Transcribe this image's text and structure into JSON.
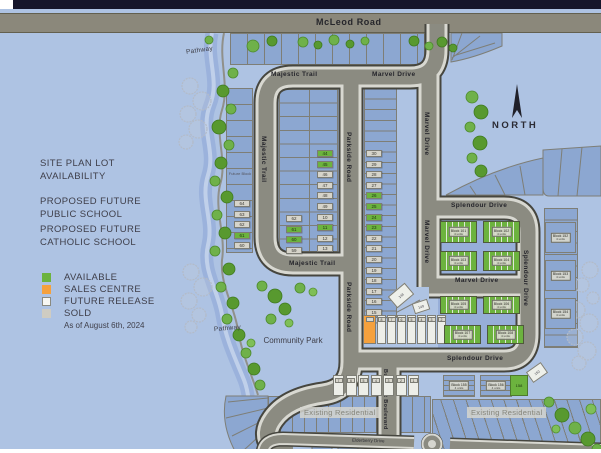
{
  "roads": {
    "mcleod": "McLeod Road",
    "majestic": "Majestic Trail",
    "marvel": "Marvel Drive",
    "parkside": "Parkside Road",
    "splendour": "Splendour Drive",
    "butternut": "Butternut Boulevard",
    "elderberry": "Elderberry Drive"
  },
  "titles": {
    "site_plan": "SITE PLAN LOT AVAILABILITY",
    "public_school": "PROPOSED FUTURE PUBLIC SCHOOL",
    "catholic_school": "PROPOSED FUTURE CATHOLIC SCHOOL"
  },
  "legend": {
    "items": [
      {
        "label": "AVAILABLE",
        "style": "available",
        "color": "#6cb33e"
      },
      {
        "label": "SALES CENTRE",
        "style": "sales",
        "color": "#f5a13d"
      },
      {
        "label": "FUTURE RELEASE",
        "style": "future",
        "color": "#f7f7f2"
      },
      {
        "label": "SOLD",
        "style": "sold",
        "color": "#cfccc2"
      }
    ],
    "as_of": "As of August 6th, 2024"
  },
  "labels": {
    "pathway": "Pathway",
    "community_park": "Community Park",
    "existing_residential": "Existing Residential",
    "north": "NORTH",
    "future_block": "Future Block"
  },
  "lots": {
    "creek_column": [
      {
        "n": "64",
        "status": "sold"
      },
      {
        "n": "63",
        "status": "sold"
      },
      {
        "n": "62",
        "status": "sold"
      },
      {
        "n": "61",
        "status": "available"
      },
      {
        "n": "60",
        "status": "sold"
      }
    ],
    "majestic_left": [
      {
        "n": "62",
        "status": "sold"
      },
      {
        "n": "61",
        "status": "available"
      },
      {
        "n": "60",
        "status": "available"
      },
      {
        "n": "59",
        "status": "sold"
      }
    ],
    "majestic_right": [
      {
        "n": "44",
        "status": "available"
      },
      {
        "n": "45",
        "status": "available"
      },
      {
        "n": "46",
        "status": "sold"
      },
      {
        "n": "47",
        "status": "sold"
      },
      {
        "n": "48",
        "status": "sold"
      },
      {
        "n": "49",
        "status": "sold"
      },
      {
        "n": "10",
        "status": "sold"
      },
      {
        "n": "11",
        "status": "available"
      },
      {
        "n": "12",
        "status": "sold"
      },
      {
        "n": "13",
        "status": "sold"
      }
    ],
    "parkside_column": [
      {
        "n": "30",
        "status": "sold"
      },
      {
        "n": "29",
        "status": "sold"
      },
      {
        "n": "28",
        "status": "sold"
      },
      {
        "n": "27",
        "status": "sold"
      },
      {
        "n": "26",
        "status": "available"
      },
      {
        "n": "25",
        "status": "available"
      },
      {
        "n": "24",
        "status": "available"
      },
      {
        "n": "23",
        "status": "available"
      },
      {
        "n": "22",
        "status": "sold"
      },
      {
        "n": "21",
        "status": "sold"
      },
      {
        "n": "20",
        "status": "sold"
      },
      {
        "n": "19",
        "status": "sold"
      },
      {
        "n": "18",
        "status": "sold"
      },
      {
        "n": "17",
        "status": "sold"
      },
      {
        "n": "16",
        "status": "sold"
      },
      {
        "n": "15",
        "status": "sold"
      }
    ],
    "sales_row": [
      {
        "n": "",
        "status": "sales"
      },
      {
        "n": "8",
        "status": "future"
      },
      {
        "n": "7",
        "status": "future"
      },
      {
        "n": "6",
        "status": "future"
      },
      {
        "n": "5",
        "status": "future"
      },
      {
        "n": "4",
        "status": "future"
      },
      {
        "n": "3",
        "status": "future"
      },
      {
        "n": "2",
        "status": "future"
      }
    ],
    "bottom_row": [
      "7",
      "6",
      "5",
      "4",
      "3",
      "2",
      "1"
    ]
  },
  "townhomes": {
    "row1": [
      {
        "name": "Block 101",
        "units": "4 units"
      },
      {
        "name": "Block 102",
        "units": "4 units"
      }
    ],
    "row2": [
      {
        "name": "Block 103",
        "units": "4 units"
      },
      {
        "name": "Block 104",
        "units": "4 units"
      }
    ],
    "row3": [
      {
        "name": "Block 105",
        "units": "4 units"
      },
      {
        "name": "Block 106",
        "units": "4 units"
      }
    ],
    "row4": [
      {
        "name": "Block 107",
        "units": "4 units"
      },
      {
        "name": "Block 108",
        "units": "4 units"
      }
    ]
  },
  "future_blocks": {
    "east": [
      {
        "name": "Block 152",
        "units": "4 units"
      },
      {
        "name": "Block 153",
        "units": "4 units"
      },
      {
        "name": "Block 154",
        "units": "4 units"
      }
    ],
    "south": [
      {
        "name": "Block 155",
        "units": "4 units"
      },
      {
        "name": "Block 156",
        "units": "4 units"
      }
    ],
    "small": [
      {
        "name": "148"
      },
      {
        "name": "149"
      },
      {
        "name": "150"
      },
      {
        "name": "158"
      }
    ]
  },
  "colors": {
    "available": "#6cb33e",
    "sales_centre": "#f5a13d",
    "future_release": "#f7f7f2",
    "sold": "#cfccc2",
    "water": "#9cb3dd",
    "road": "#8b8b81",
    "background": "#aec3e3",
    "lot_fill": "#8ca7d1"
  }
}
